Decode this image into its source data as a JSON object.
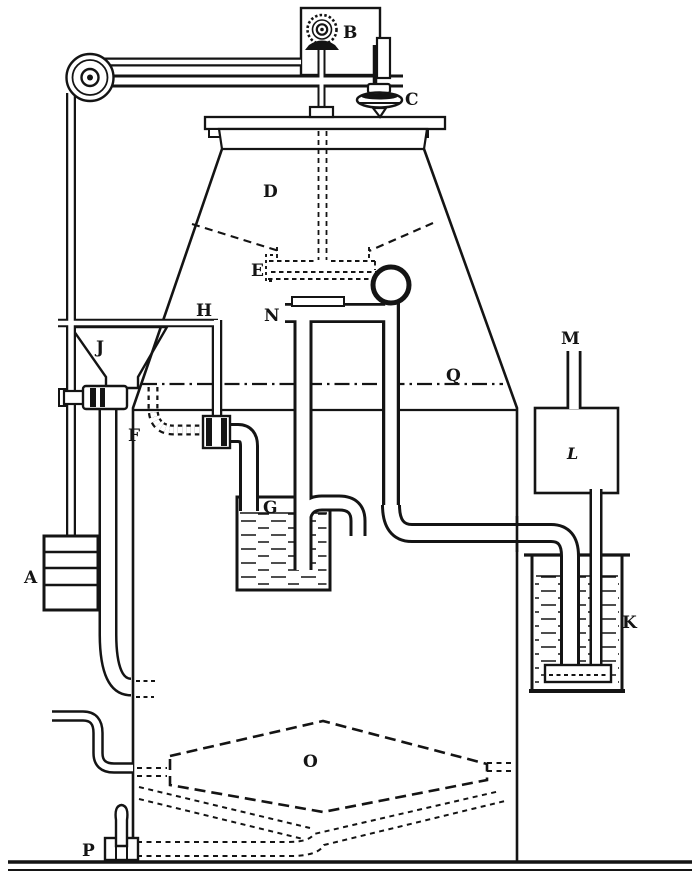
{
  "figure": {
    "labels": {
      "A": "A",
      "B": "B",
      "C": "C",
      "D": "D",
      "E": "E",
      "F": "F",
      "G": "G",
      "H": "H",
      "J": "J",
      "K": "K",
      "L": "L",
      "M": "M",
      "N": "N",
      "O": "O",
      "P": "P",
      "Q": "Q"
    }
  }
}
